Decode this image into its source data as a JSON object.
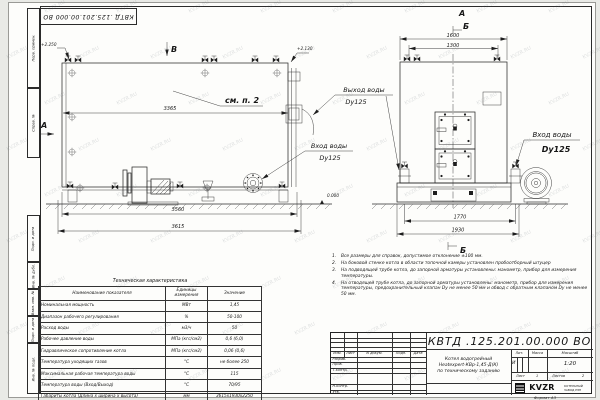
{
  "meta": {
    "watermark": "KVZR.RU",
    "stamp": "КВТД .125.201.00.000  ВО",
    "format_label": "Формат  А3"
  },
  "frame": {
    "labels": [
      "Перв. примен.",
      "Справ. №",
      "Подп. и дата",
      "Инв. № дубл.",
      "Взам. инв. №",
      "Подп. и дата",
      "Инв. № подл."
    ]
  },
  "drawing": {
    "markers": {
      "b_top": "В",
      "a_left": "А",
      "a_front": "А",
      "b_front": "Б",
      "b_bottom": "Б"
    },
    "elevations": {
      "left": "+2.250",
      "right": "+2.130",
      "zero": "0.000"
    },
    "callout": "см. п. 2",
    "dims": {
      "side_inner": "3365",
      "side_mid": "3560",
      "side_outer": "3615",
      "front_top_outer": "1600",
      "front_top_inner": "1300",
      "front_bottom_inner": "1770",
      "front_bottom_outer": "1930"
    },
    "labels": {
      "outlet": "Выход воды",
      "outlet_dn": "Dy125",
      "inlet_mid": "Вход воды",
      "inlet_mid_dn": "Dy125",
      "inlet_right": "Вход воды",
      "inlet_right_dn": "Dy125"
    }
  },
  "table": {
    "title": "Техническая характеристика",
    "headers": [
      "Наименование показателя",
      "Единицы измерения",
      "Значение"
    ],
    "rows": [
      [
        "Номинальная мощность",
        "МВт",
        "1,45"
      ],
      [
        "Диапазон рабочего регулирования",
        "%",
        "50-100"
      ],
      [
        "Расход воды",
        "м3/ч",
        "50"
      ],
      [
        "Рабочее давление воды",
        "МПа (кгс/см2)",
        "0,6 (6,0)"
      ],
      [
        "Гидравлическое сопротивление котла",
        "МПа (кгс/см2)",
        "0,06 (0,6)"
      ],
      [
        "Температура уходящих газов",
        "°С",
        "не более 250"
      ],
      [
        "Максимальная рабочая температура воды",
        "°С",
        "115"
      ],
      [
        "Температура воды (Вход/Выход)",
        "°С",
        "70/95"
      ],
      [
        "Габариты котла (Длина х ширина х высота)",
        "мм",
        "3615х1930х2250"
      ]
    ]
  },
  "notes": [
    {
      "num": "1.",
      "text": "Все размеры для справок, допустимое отклонение ±100 мм."
    },
    {
      "num": "2.",
      "text": "На боковой стенке котла в области топочной камеры установлен пробоотборный штуцер"
    },
    {
      "num": "3.",
      "text": "На подводящей трубе котла, до запорной арматуры установлены: манометр, прибор для измерения температуры."
    },
    {
      "num": "4.",
      "text": "На отводящей трубе котла, до запорной арматуры установлены: манометр, прибор для измерения температуры, предохранительный клапан Dу не менее 50 мм и обвод с обратным клапаном Dу не менее 50 мм."
    }
  ],
  "titleblock": {
    "doc_number": "КВТД .125.201.00.000  ВО",
    "rev_headers": [
      "Изм.",
      "Лист",
      "N докум.",
      "Подп.",
      "Дата"
    ],
    "sign_rows": [
      "Разраб.",
      "Пров.",
      "Т.контр.",
      "Н.контр.",
      "Утв."
    ],
    "description": [
      "Котел водогрейный",
      "Heatexpert-КВр-1,45-Д(К)",
      "по техническому заданию"
    ],
    "lit_label": "Лит.",
    "lit_value": "И",
    "mass_label": "Масса",
    "scale_label": "Масштаб",
    "scale_value": "1:20",
    "sheet_label": "Лист",
    "sheet_value": "1",
    "sheets_label": "Листов",
    "sheets_value": "2",
    "logo_text": "KVZR",
    "company": [
      "КОТЕЛЬНЫЙ",
      "ЗАВОД РЭП"
    ]
  }
}
